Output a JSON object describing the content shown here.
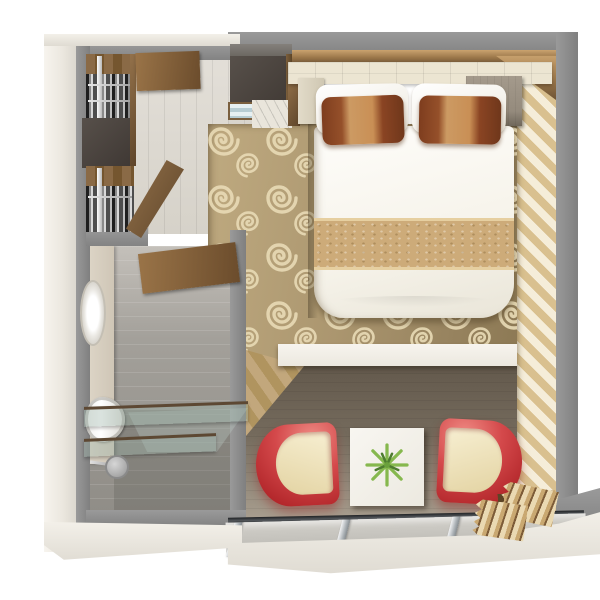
{
  "page": {
    "title": "Cabin floor plan — 3D top-down render",
    "render_type": "3d-floor-plan"
  },
  "palette": {
    "wall_top": "#8f8f8f",
    "wall_face": "#f1ede5",
    "trim_bronze": "#a9824f",
    "carpet_base": "#a8936c",
    "carpet_swirl": "#e7d9b4",
    "stripe_gold": "#d9c08f",
    "stripe_cream": "#f5edd9",
    "tile_floor": "#dcd8d0",
    "bath_floor": "#9b9792",
    "wood_floor": "#7d7264",
    "desk_white": "#f3f0e9",
    "bed_white": "#faf8f2",
    "runner_gold": "#cdab79",
    "pillow_rust": "#8a4423",
    "pillow_tan": "#c08048",
    "chair_red": "#c23a3e",
    "chair_seat": "#ede2bd",
    "glass": "#c9c7c1",
    "curtain_beige": "#e5d6b2",
    "cabinet_dark": "#4a423d",
    "cabinet_wood": "#8a6a46",
    "plant_green": "#7fb34a"
  },
  "plan": {
    "entry": {
      "label": "Entry hall",
      "items": [
        {
          "id": "entry-door",
          "label": "Entry door (open, wood)"
        },
        {
          "id": "closet-door",
          "label": "Wardrobe door (open)"
        },
        {
          "id": "tile-floor",
          "label": "Tiled entry floor"
        }
      ]
    },
    "closet": {
      "label": "Wardrobes",
      "items": [
        {
          "id": "wardrobe-upper",
          "label": "Wardrobe with hanging clothes"
        },
        {
          "id": "storage-cabinet",
          "label": "Dark storage cabinet"
        },
        {
          "id": "wardrobe-lower",
          "label": "Wardrobe with hanging clothes"
        }
      ]
    },
    "minibar": {
      "label": "Minibar unit",
      "items": [
        {
          "id": "minibar-cabinet",
          "label": "Dark overhead minibar cabinet"
        },
        {
          "id": "minibar-shelves",
          "label": "Glass minibar shelves"
        }
      ]
    },
    "bathroom": {
      "label": "Bathroom",
      "items": [
        {
          "id": "bathroom-door",
          "label": "Bathroom door (wood, ajar)"
        },
        {
          "id": "vanity",
          "label": "Vanity counter"
        },
        {
          "id": "sink",
          "label": "Washbasin"
        },
        {
          "id": "toilet",
          "label": "Toilet"
        },
        {
          "id": "shower-screen",
          "label": "Folding glass shower screen"
        },
        {
          "id": "shower-head",
          "label": "Shower head"
        }
      ]
    },
    "bedroom": {
      "label": "Bedroom",
      "items": [
        {
          "id": "headboard",
          "label": "Upholstered headboard panel"
        },
        {
          "id": "bed",
          "label": "Double bed with white duvet and gold runner"
        },
        {
          "id": "pillows",
          "label": "White pillows with rust accent pillows"
        },
        {
          "id": "nightstand-left",
          "label": "Left bedside cabinet"
        },
        {
          "id": "nightstand-right",
          "label": "Right nightstand"
        },
        {
          "id": "carpet",
          "label": "Swirl-patterned carpet"
        },
        {
          "id": "striped-wall",
          "label": "Gold striped side wall"
        }
      ]
    },
    "sitting": {
      "label": "Sitting area",
      "items": [
        {
          "id": "desk-shelf",
          "label": "White desk shelf"
        },
        {
          "id": "wood-floor",
          "label": "Dark wood floor"
        },
        {
          "id": "coffee-table",
          "label": "White coffee table"
        },
        {
          "id": "plant",
          "label": "Green plant centerpiece"
        },
        {
          "id": "chair-left",
          "label": "Red tub chair (left)"
        },
        {
          "id": "chair-right",
          "label": "Red tub chair (right)"
        }
      ]
    },
    "balcony": {
      "label": "Balcony front",
      "items": [
        {
          "id": "sliding-door",
          "label": "Sliding glass balcony doors"
        },
        {
          "id": "curtain",
          "label": "Pleated beige curtain"
        }
      ]
    }
  }
}
